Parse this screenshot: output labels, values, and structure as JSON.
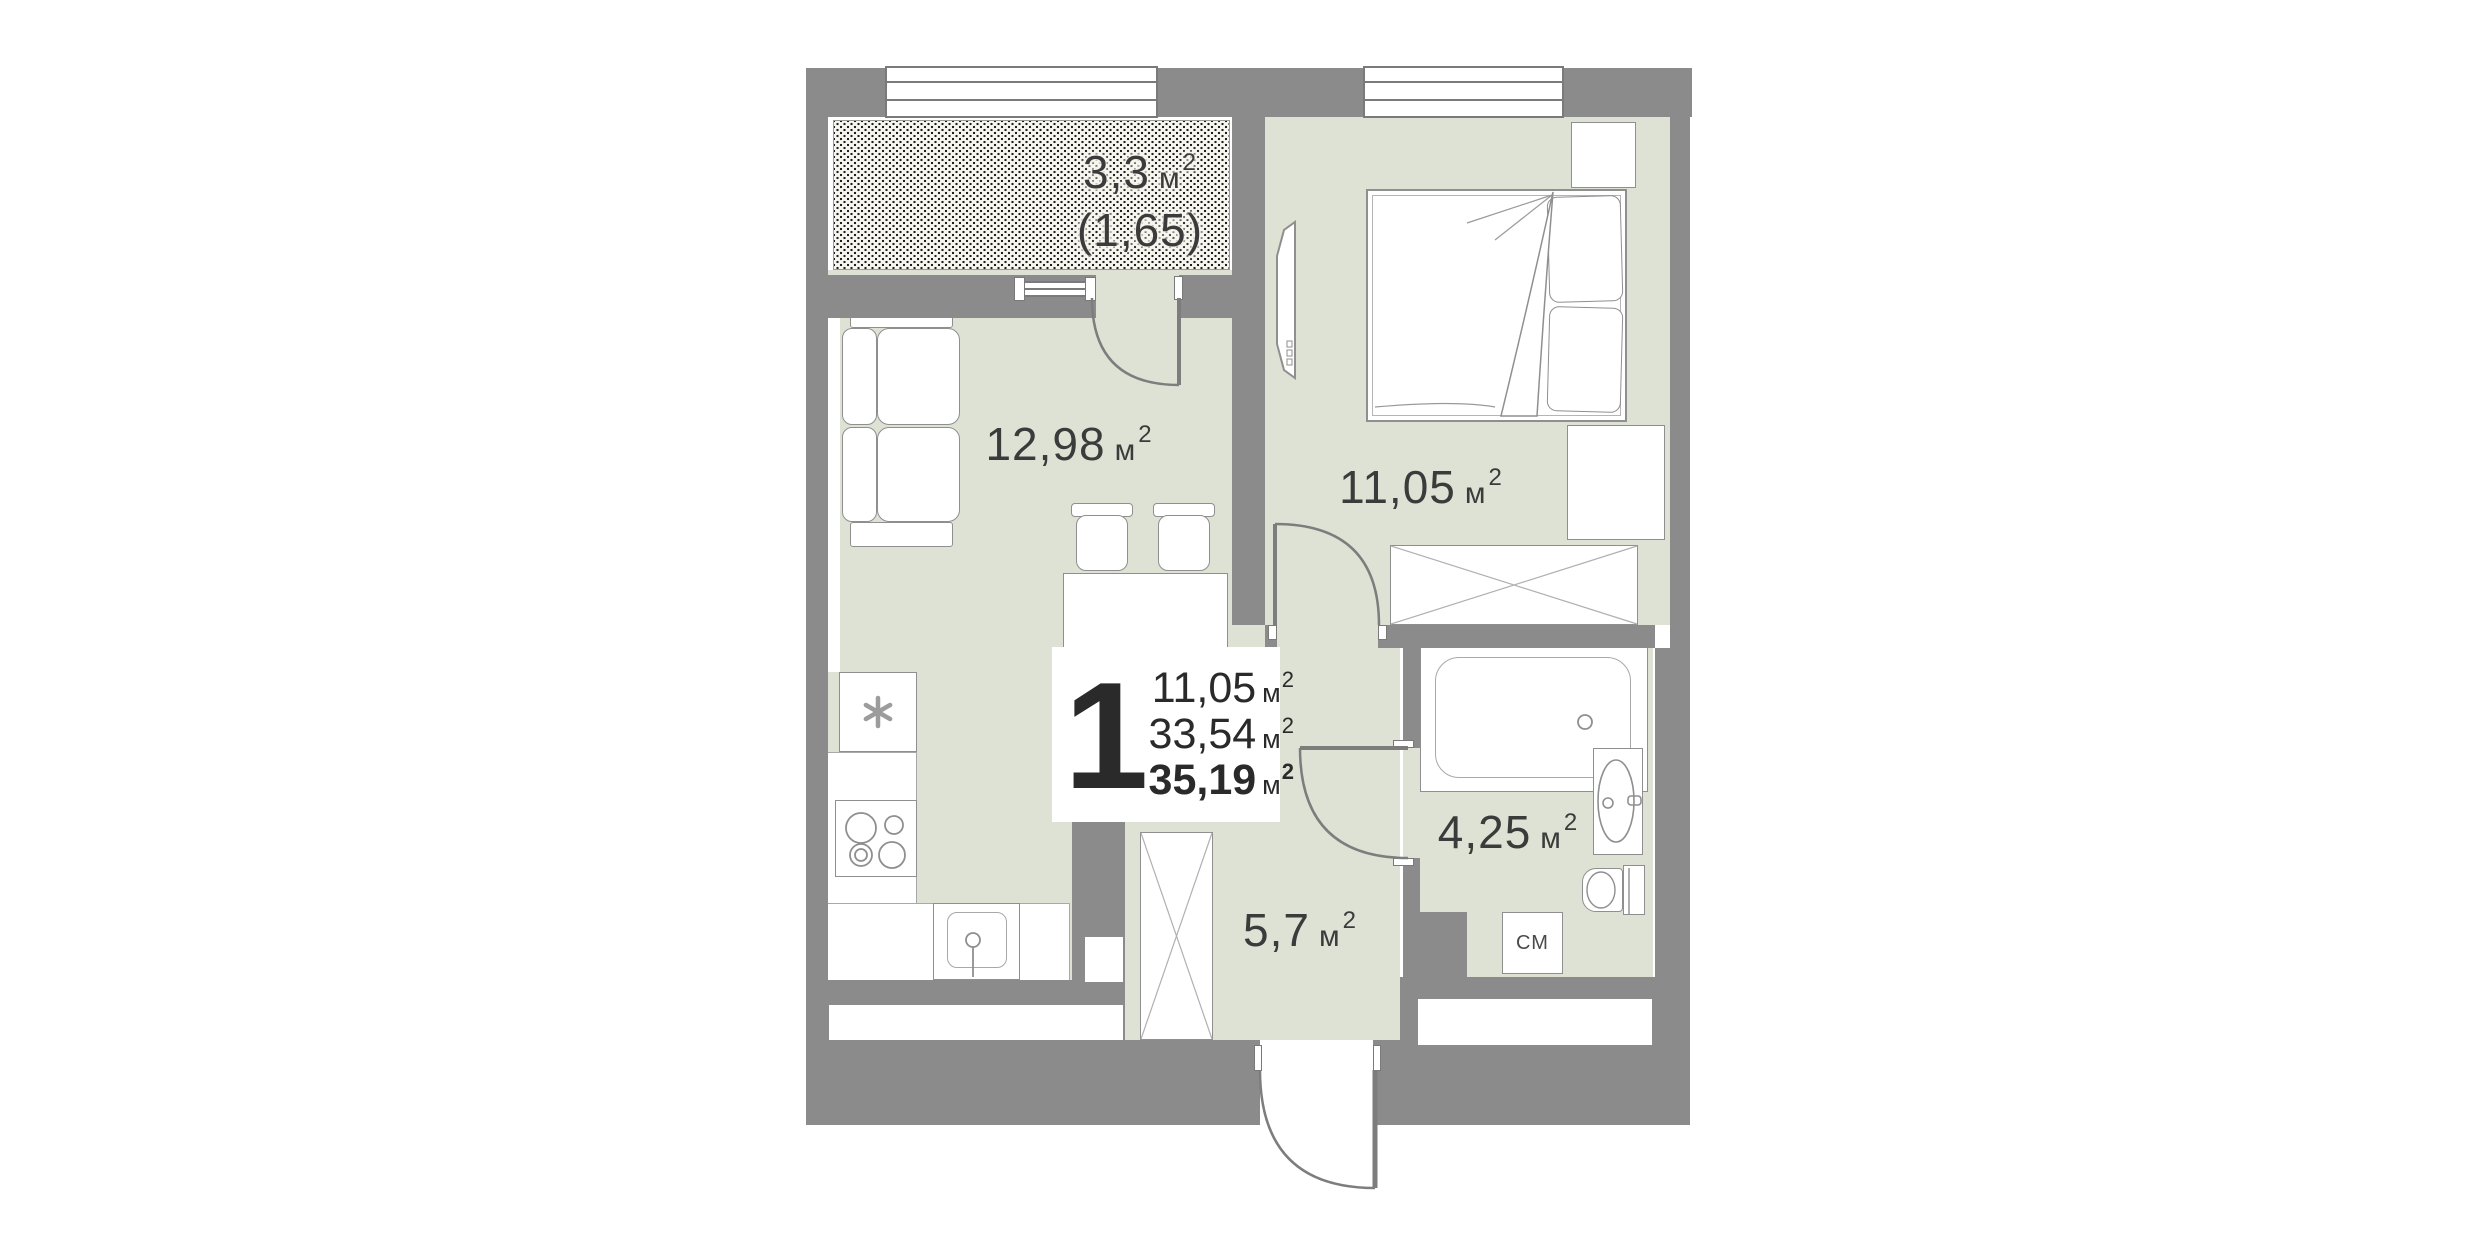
{
  "page": {
    "background": "#ffffff",
    "type": "apartment-floor-plan"
  },
  "colors": {
    "wall": "#8b8b8b",
    "floor": "#dde2d4",
    "furniture_outline": "#8f8f8f",
    "label_text": "#3b3b3b",
    "card_text": "#2a2a2a",
    "hatch_dot": "#1c1c1c"
  },
  "unit_card": {
    "room_count": "1",
    "areas": [
      {
        "value": "11,05",
        "unit": "м",
        "sup": "2",
        "bold": false
      },
      {
        "value": "33,54",
        "unit": "м",
        "sup": "2",
        "bold": false
      },
      {
        "value": "35,19",
        "unit": "м",
        "sup": "2",
        "bold": true
      }
    ]
  },
  "labels": {
    "balcony": {
      "value": "3,3",
      "unit": "м",
      "sup": "2",
      "reduced": "(1,65)"
    },
    "living": {
      "value": "12,98",
      "unit": "м",
      "sup": "2"
    },
    "bedroom": {
      "value": "11,05",
      "unit": "м",
      "sup": "2"
    },
    "bathroom": {
      "value": "4,25",
      "unit": "м",
      "sup": "2"
    },
    "hallway": {
      "value": "5,7",
      "unit": "м",
      "sup": "2"
    },
    "washing_machine": "СМ"
  }
}
